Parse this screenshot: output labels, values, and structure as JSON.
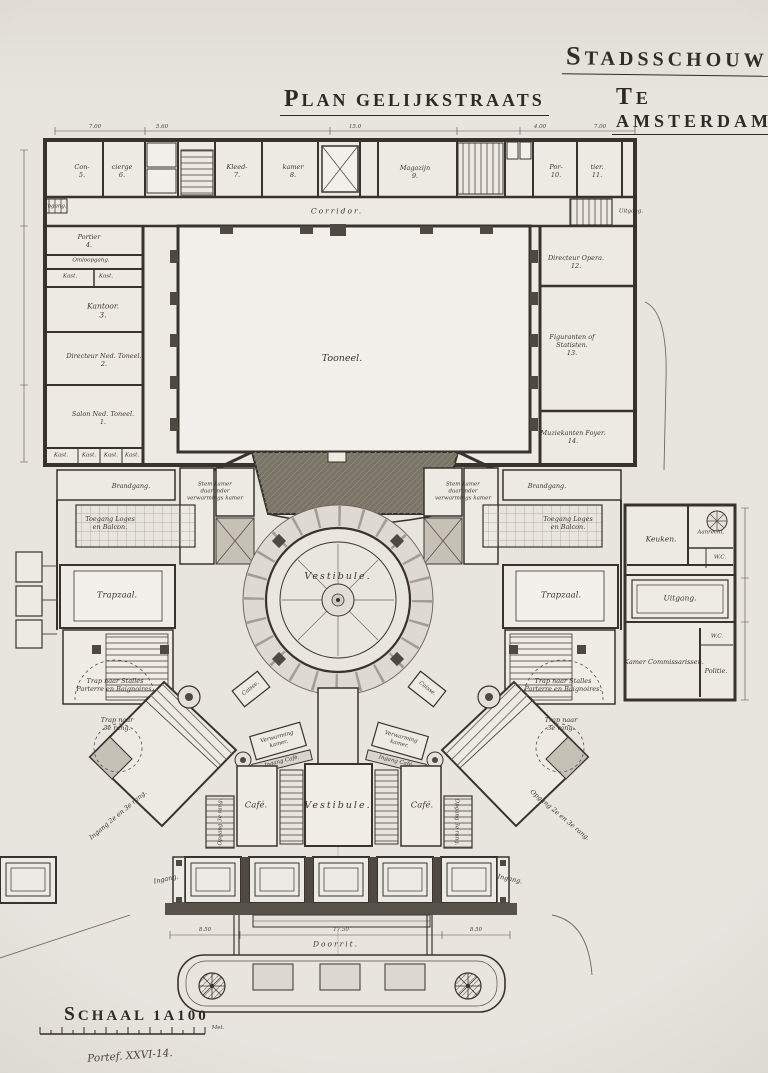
{
  "titles": {
    "project1": "Stadsschouwburg",
    "project2": "te Amsterdam",
    "sheet": "Plan Gelijkstraats"
  },
  "scale": {
    "label": "Schaal 1a100",
    "unit": "Met.",
    "signature": "Portef. XXVI-14."
  },
  "dims": {
    "top": [
      "7.00",
      "5.60",
      "15.0",
      "4.00",
      "7.00"
    ],
    "bottom": [
      "8.50",
      "17.50",
      "8.50"
    ]
  },
  "backstage": {
    "corridor": "Corridor.",
    "ingang_left": "Ingang.",
    "uitgang_right": "Uitgang.",
    "top_rooms": [
      "Con-\n5.",
      "cierge\n6.",
      "Kleed-\n7.",
      "kamer\n8.",
      "Magazijn\n9.",
      "Por-\n10.",
      "tier.\n11."
    ],
    "left_wing": {
      "portier": "Portier\n4.",
      "omloopgang": "Omloopgang.",
      "kast": "Kast.",
      "kantoor": "Kantoor.\n3.",
      "directeur": "Directeur Ned. Toneel.\n2.",
      "salon": "Salon Ned. Toneel.\n1."
    },
    "right_wing": {
      "directeur_opera": "Directeur Opera.\n12.",
      "figuranten": "Figuranten of\nStatisten.\n13.",
      "muziekanten": "Muziekanten Foyer.\n14."
    },
    "stage": "Tooneel."
  },
  "midhouse": {
    "brandgang": "Brandgang.",
    "stemkamer": "Stem kamer\ndaaronder\nverwarmings kamer",
    "toegang": "Toegang Loges\nen Balcon.",
    "vestibule": "Vestibule.",
    "trapzaal": "Trapzaal.",
    "trap_stalles": "Trap naar Stalles\nParterre en Baignoires.",
    "trap_rang": "Trap naar\n3e rang.",
    "caisse": "Caisse."
  },
  "annex": {
    "keuken": "Keuken.",
    "aanrecht": "Aanrecht.",
    "wc": "W.C.",
    "uitgang": "Uitgang.",
    "kamer_commissarissen": "Kamer Commissarissen.",
    "politie": "Politie."
  },
  "lobby": {
    "verwarming": "Verwarming\nkamer.",
    "ingang_cafe": "Ingang Café.",
    "cafe": "Café.",
    "vestibule": "Vestibule.",
    "opgang_rang": "Opgang 3e rang.",
    "ingang_diag_left": "Ingang 2e en 3e rang.",
    "opgang_diag_right": "Opgang 2e en 3e rang.",
    "ingang_left": "Ingang.",
    "ingang_right": "Ingang.",
    "doorrit": "Doorrit."
  }
}
